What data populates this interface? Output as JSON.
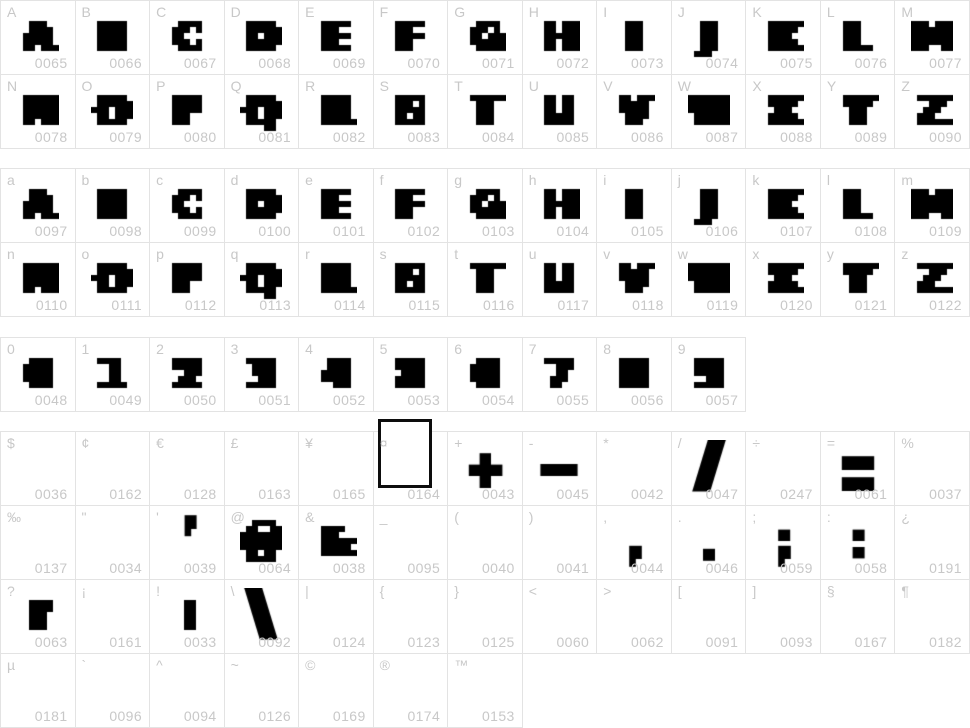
{
  "page": {
    "background": "#ffffff",
    "border_color": "#e3e3e3",
    "label_color": "#c8c8c8",
    "code_color": "#c8c8c8",
    "glyph_color": "#000000"
  },
  "groups": [
    {
      "name": "uppercase",
      "rows": [
        {
          "cells": [
            {
              "label": "A",
              "code": "0065",
              "glyph": "A"
            },
            {
              "label": "B",
              "code": "0066",
              "glyph": "B"
            },
            {
              "label": "C",
              "code": "0067",
              "glyph": "C"
            },
            {
              "label": "D",
              "code": "0068",
              "glyph": "D"
            },
            {
              "label": "E",
              "code": "0069",
              "glyph": "E"
            },
            {
              "label": "F",
              "code": "0070",
              "glyph": "F"
            },
            {
              "label": "G",
              "code": "0071",
              "glyph": "G"
            },
            {
              "label": "H",
              "code": "0072",
              "glyph": "H"
            },
            {
              "label": "I",
              "code": "0073",
              "glyph": "I"
            },
            {
              "label": "J",
              "code": "0074",
              "glyph": "J"
            },
            {
              "label": "K",
              "code": "0075",
              "glyph": "K"
            },
            {
              "label": "L",
              "code": "0076",
              "glyph": "L"
            },
            {
              "label": "M",
              "code": "0077",
              "glyph": "M"
            }
          ]
        },
        {
          "cells": [
            {
              "label": "N",
              "code": "0078",
              "glyph": "N"
            },
            {
              "label": "O",
              "code": "0079",
              "glyph": "O"
            },
            {
              "label": "P",
              "code": "0080",
              "glyph": "P"
            },
            {
              "label": "Q",
              "code": "0081",
              "glyph": "Q"
            },
            {
              "label": "R",
              "code": "0082",
              "glyph": "R"
            },
            {
              "label": "S",
              "code": "0083",
              "glyph": "S"
            },
            {
              "label": "T",
              "code": "0084",
              "glyph": "T"
            },
            {
              "label": "U",
              "code": "0085",
              "glyph": "U"
            },
            {
              "label": "V",
              "code": "0086",
              "glyph": "V"
            },
            {
              "label": "W",
              "code": "0087",
              "glyph": "W"
            },
            {
              "label": "X",
              "code": "0088",
              "glyph": "X"
            },
            {
              "label": "Y",
              "code": "0089",
              "glyph": "Y"
            },
            {
              "label": "Z",
              "code": "0090",
              "glyph": "Z"
            }
          ]
        }
      ]
    },
    {
      "name": "lowercase",
      "rows": [
        {
          "cells": [
            {
              "label": "a",
              "code": "0097",
              "glyph": "A"
            },
            {
              "label": "b",
              "code": "0098",
              "glyph": "B"
            },
            {
              "label": "c",
              "code": "0099",
              "glyph": "C"
            },
            {
              "label": "d",
              "code": "0100",
              "glyph": "D"
            },
            {
              "label": "e",
              "code": "0101",
              "glyph": "E"
            },
            {
              "label": "f",
              "code": "0102",
              "glyph": "F"
            },
            {
              "label": "g",
              "code": "0103",
              "glyph": "G"
            },
            {
              "label": "h",
              "code": "0104",
              "glyph": "H"
            },
            {
              "label": "i",
              "code": "0105",
              "glyph": "I"
            },
            {
              "label": "j",
              "code": "0106",
              "glyph": "J"
            },
            {
              "label": "k",
              "code": "0107",
              "glyph": "K"
            },
            {
              "label": "l",
              "code": "0108",
              "glyph": "L"
            },
            {
              "label": "m",
              "code": "0109",
              "glyph": "M"
            }
          ]
        },
        {
          "cells": [
            {
              "label": "n",
              "code": "0110",
              "glyph": "N"
            },
            {
              "label": "o",
              "code": "0111",
              "glyph": "O"
            },
            {
              "label": "p",
              "code": "0112",
              "glyph": "P"
            },
            {
              "label": "q",
              "code": "0113",
              "glyph": "Q"
            },
            {
              "label": "r",
              "code": "0114",
              "glyph": "R"
            },
            {
              "label": "s",
              "code": "0115",
              "glyph": "S"
            },
            {
              "label": "t",
              "code": "0116",
              "glyph": "T"
            },
            {
              "label": "u",
              "code": "0117",
              "glyph": "U"
            },
            {
              "label": "v",
              "code": "0118",
              "glyph": "V"
            },
            {
              "label": "w",
              "code": "0119",
              "glyph": "W"
            },
            {
              "label": "x",
              "code": "0120",
              "glyph": "X"
            },
            {
              "label": "y",
              "code": "0121",
              "glyph": "Y"
            },
            {
              "label": "z",
              "code": "0122",
              "glyph": "Z"
            }
          ]
        }
      ]
    },
    {
      "name": "digits",
      "rows": [
        {
          "cells": [
            {
              "label": "0",
              "code": "0048",
              "glyph": "0"
            },
            {
              "label": "1",
              "code": "0049",
              "glyph": "1"
            },
            {
              "label": "2",
              "code": "0050",
              "glyph": "2"
            },
            {
              "label": "3",
              "code": "0051",
              "glyph": "3"
            },
            {
              "label": "4",
              "code": "0052",
              "glyph": "4"
            },
            {
              "label": "5",
              "code": "0053",
              "glyph": "5"
            },
            {
              "label": "6",
              "code": "0054",
              "glyph": "6"
            },
            {
              "label": "7",
              "code": "0055",
              "glyph": "7"
            },
            {
              "label": "8",
              "code": "0056",
              "glyph": "8"
            },
            {
              "label": "9",
              "code": "0057",
              "glyph": "9"
            }
          ]
        }
      ]
    },
    {
      "name": "symbols",
      "rows": [
        {
          "cells": [
            {
              "label": "$",
              "code": "0036",
              "glyph": ""
            },
            {
              "label": "¢",
              "code": "0162",
              "glyph": ""
            },
            {
              "label": "€",
              "code": "0128",
              "glyph": ""
            },
            {
              "label": "£",
              "code": "0163",
              "glyph": ""
            },
            {
              "label": "¥",
              "code": "0165",
              "glyph": ""
            },
            {
              "label": "¤",
              "code": "0164",
              "glyph": "notdef"
            },
            {
              "label": "+",
              "code": "0043",
              "glyph": "+"
            },
            {
              "label": "-",
              "code": "0045",
              "glyph": "-"
            },
            {
              "label": "*",
              "code": "0042",
              "glyph": ""
            },
            {
              "label": "/",
              "code": "0047",
              "glyph": "/"
            },
            {
              "label": "÷",
              "code": "0247",
              "glyph": ""
            },
            {
              "label": "=",
              "code": "0061",
              "glyph": "="
            },
            {
              "label": "%",
              "code": "0037",
              "glyph": ""
            }
          ]
        },
        {
          "cells": [
            {
              "label": "‰",
              "code": "0137",
              "glyph": ""
            },
            {
              "label": "\"",
              "code": "0034",
              "glyph": ""
            },
            {
              "label": "'",
              "code": "0039",
              "glyph": "'"
            },
            {
              "label": "@",
              "code": "0064",
              "glyph": "@"
            },
            {
              "label": "&",
              "code": "0038",
              "glyph": "&"
            },
            {
              "label": "_",
              "code": "0095",
              "glyph": ""
            },
            {
              "label": "(",
              "code": "0040",
              "glyph": ""
            },
            {
              "label": ")",
              "code": "0041",
              "glyph": ""
            },
            {
              "label": ",",
              "code": "0044",
              "glyph": ","
            },
            {
              "label": ".",
              "code": "0046",
              "glyph": "."
            },
            {
              "label": ";",
              "code": "0059",
              "glyph": ";"
            },
            {
              "label": ":",
              "code": "0058",
              "glyph": ":"
            },
            {
              "label": "¿",
              "code": "0191",
              "glyph": ""
            }
          ]
        },
        {
          "cells": [
            {
              "label": "?",
              "code": "0063",
              "glyph": "?"
            },
            {
              "label": "¡",
              "code": "0161",
              "glyph": ""
            },
            {
              "label": "!",
              "code": "0033",
              "glyph": "!"
            },
            {
              "label": "\\",
              "code": "0092",
              "glyph": "\\"
            },
            {
              "label": "|",
              "code": "0124",
              "glyph": ""
            },
            {
              "label": "{",
              "code": "0123",
              "glyph": ""
            },
            {
              "label": "}",
              "code": "0125",
              "glyph": ""
            },
            {
              "label": "<",
              "code": "0060",
              "glyph": ""
            },
            {
              "label": ">",
              "code": "0062",
              "glyph": ""
            },
            {
              "label": "[",
              "code": "0091",
              "glyph": ""
            },
            {
              "label": "]",
              "code": "0093",
              "glyph": ""
            },
            {
              "label": "§",
              "code": "0167",
              "glyph": ""
            },
            {
              "label": "¶",
              "code": "0182",
              "glyph": ""
            }
          ]
        },
        {
          "cells": [
            {
              "label": "µ",
              "code": "0181",
              "glyph": ""
            },
            {
              "label": "`",
              "code": "0096",
              "glyph": ""
            },
            {
              "label": "^",
              "code": "0094",
              "glyph": ""
            },
            {
              "label": "~",
              "code": "0126",
              "glyph": ""
            },
            {
              "label": "©",
              "code": "0169",
              "glyph": ""
            },
            {
              "label": "®",
              "code": "0174",
              "glyph": ""
            },
            {
              "label": "™",
              "code": "0153",
              "glyph": ""
            }
          ]
        }
      ]
    }
  ]
}
